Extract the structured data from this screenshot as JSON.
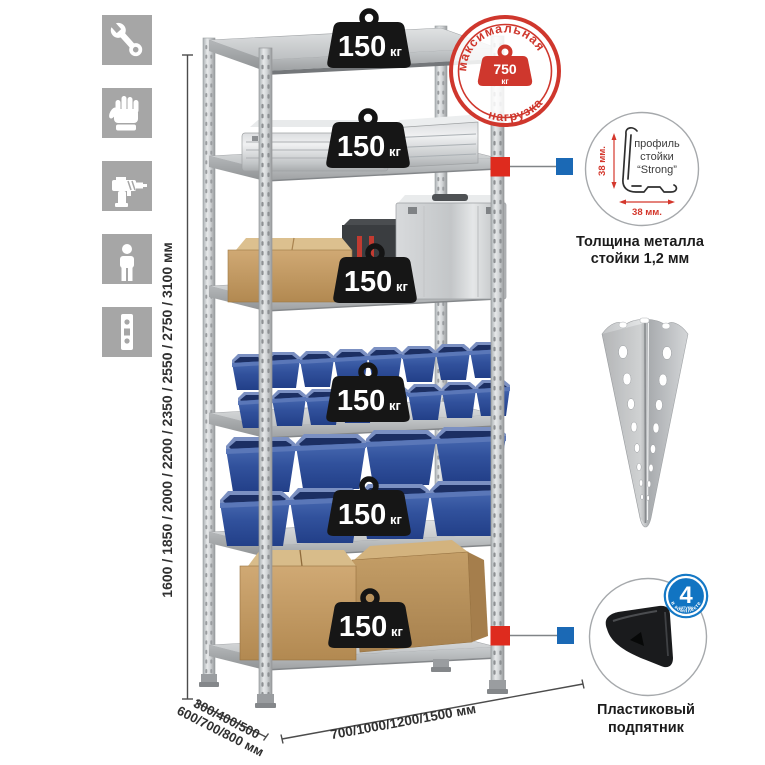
{
  "colors": {
    "accent_red": "#de2b1e",
    "accent_blue": "#1b69b5",
    "stamp_red": "#cf372d",
    "metal_gray": "#c6c9cb",
    "bin_blue": "#31519c",
    "cardboard": "#c7a26b",
    "icon_square_gray": "#a6a6a6"
  },
  "left_icons": {
    "items": [
      {
        "name": "wrench-icon"
      },
      {
        "name": "gloves-icon"
      },
      {
        "name": "drill-icon"
      },
      {
        "name": "person-icon"
      },
      {
        "name": "rack-profile-icon"
      }
    ]
  },
  "rack": {
    "load_unit": "кг",
    "shelves": [
      {
        "load": "150"
      },
      {
        "load": "150"
      },
      {
        "load": "150"
      },
      {
        "load": "150"
      },
      {
        "load": "150"
      },
      {
        "load": "150"
      }
    ]
  },
  "stamp": {
    "arc_top": "максимальная",
    "arc_bottom": "нагрузка",
    "value": "750",
    "unit": "кг"
  },
  "dimensions": {
    "height": "1600 / 1850 / 2000 / 2200 / 2350 / 2550 / 2750 / 3100 мм",
    "depth_line1": "300/400/500",
    "depth_line2": "600/700/800 мм",
    "width": "700/1000/1200/1500 мм"
  },
  "profile_callout": {
    "dim_vertical": "38 мм.",
    "dim_horizontal": "38 мм.",
    "label_line1": "профиль",
    "label_line2": "стойки",
    "label_line3": "“Strong”",
    "caption_line1": "Толщина металла",
    "caption_line2": "стойки 1,2 мм"
  },
  "foot_callout": {
    "badge_value": "4",
    "badge_sub": "штуки",
    "badge_arc": "в комплекте",
    "caption_line1": "Пластиковый",
    "caption_line2": "подпятник"
  }
}
